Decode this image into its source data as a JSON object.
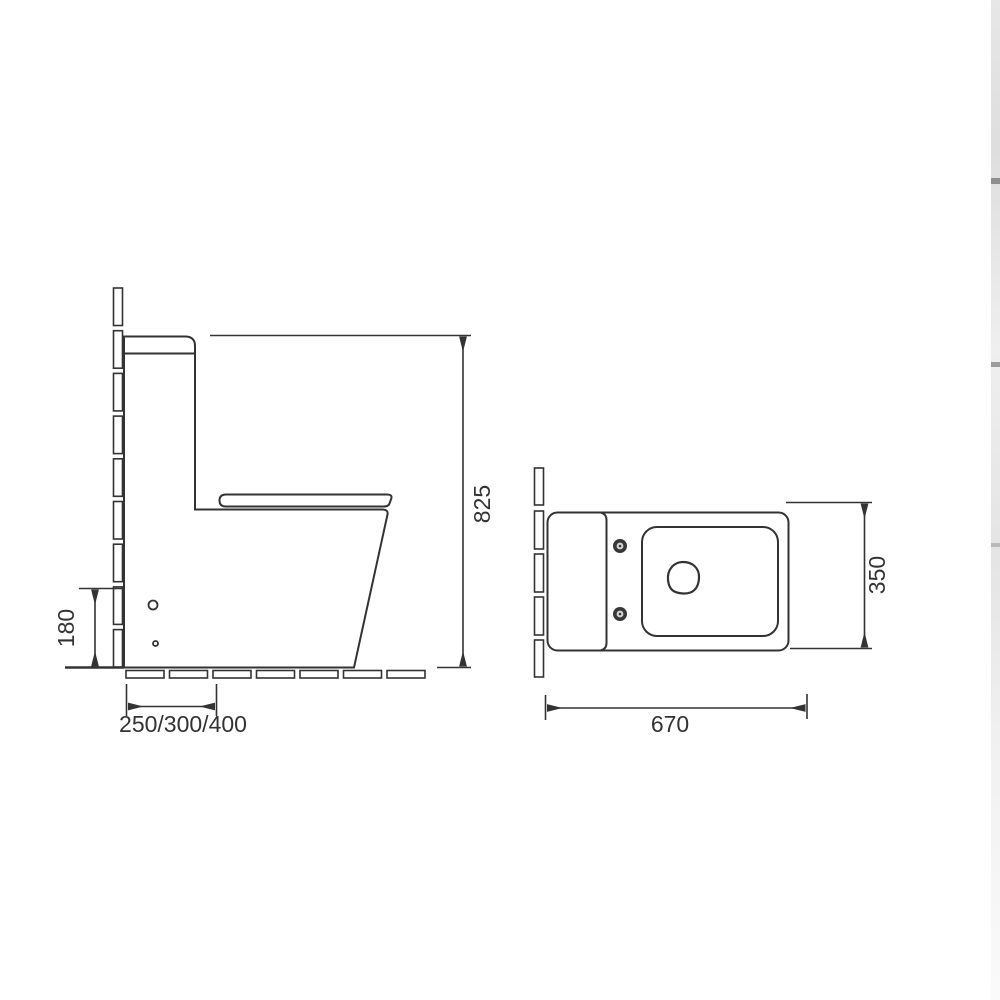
{
  "window": {
    "background": "#ffffff"
  },
  "palette": {
    "line_color": "#333333",
    "text_color": "#333333",
    "edge_strip_color": "#e7e7e7"
  },
  "diagram": {
    "kind": "technical dimension drawing - one-piece toilet, side view and top view",
    "side_view": {
      "dim_total_height": "825",
      "dim_outlet_height": "180",
      "dim_rough_in": "250/300/400"
    },
    "top_view": {
      "dim_depth": "350",
      "dim_width": "670"
    }
  }
}
